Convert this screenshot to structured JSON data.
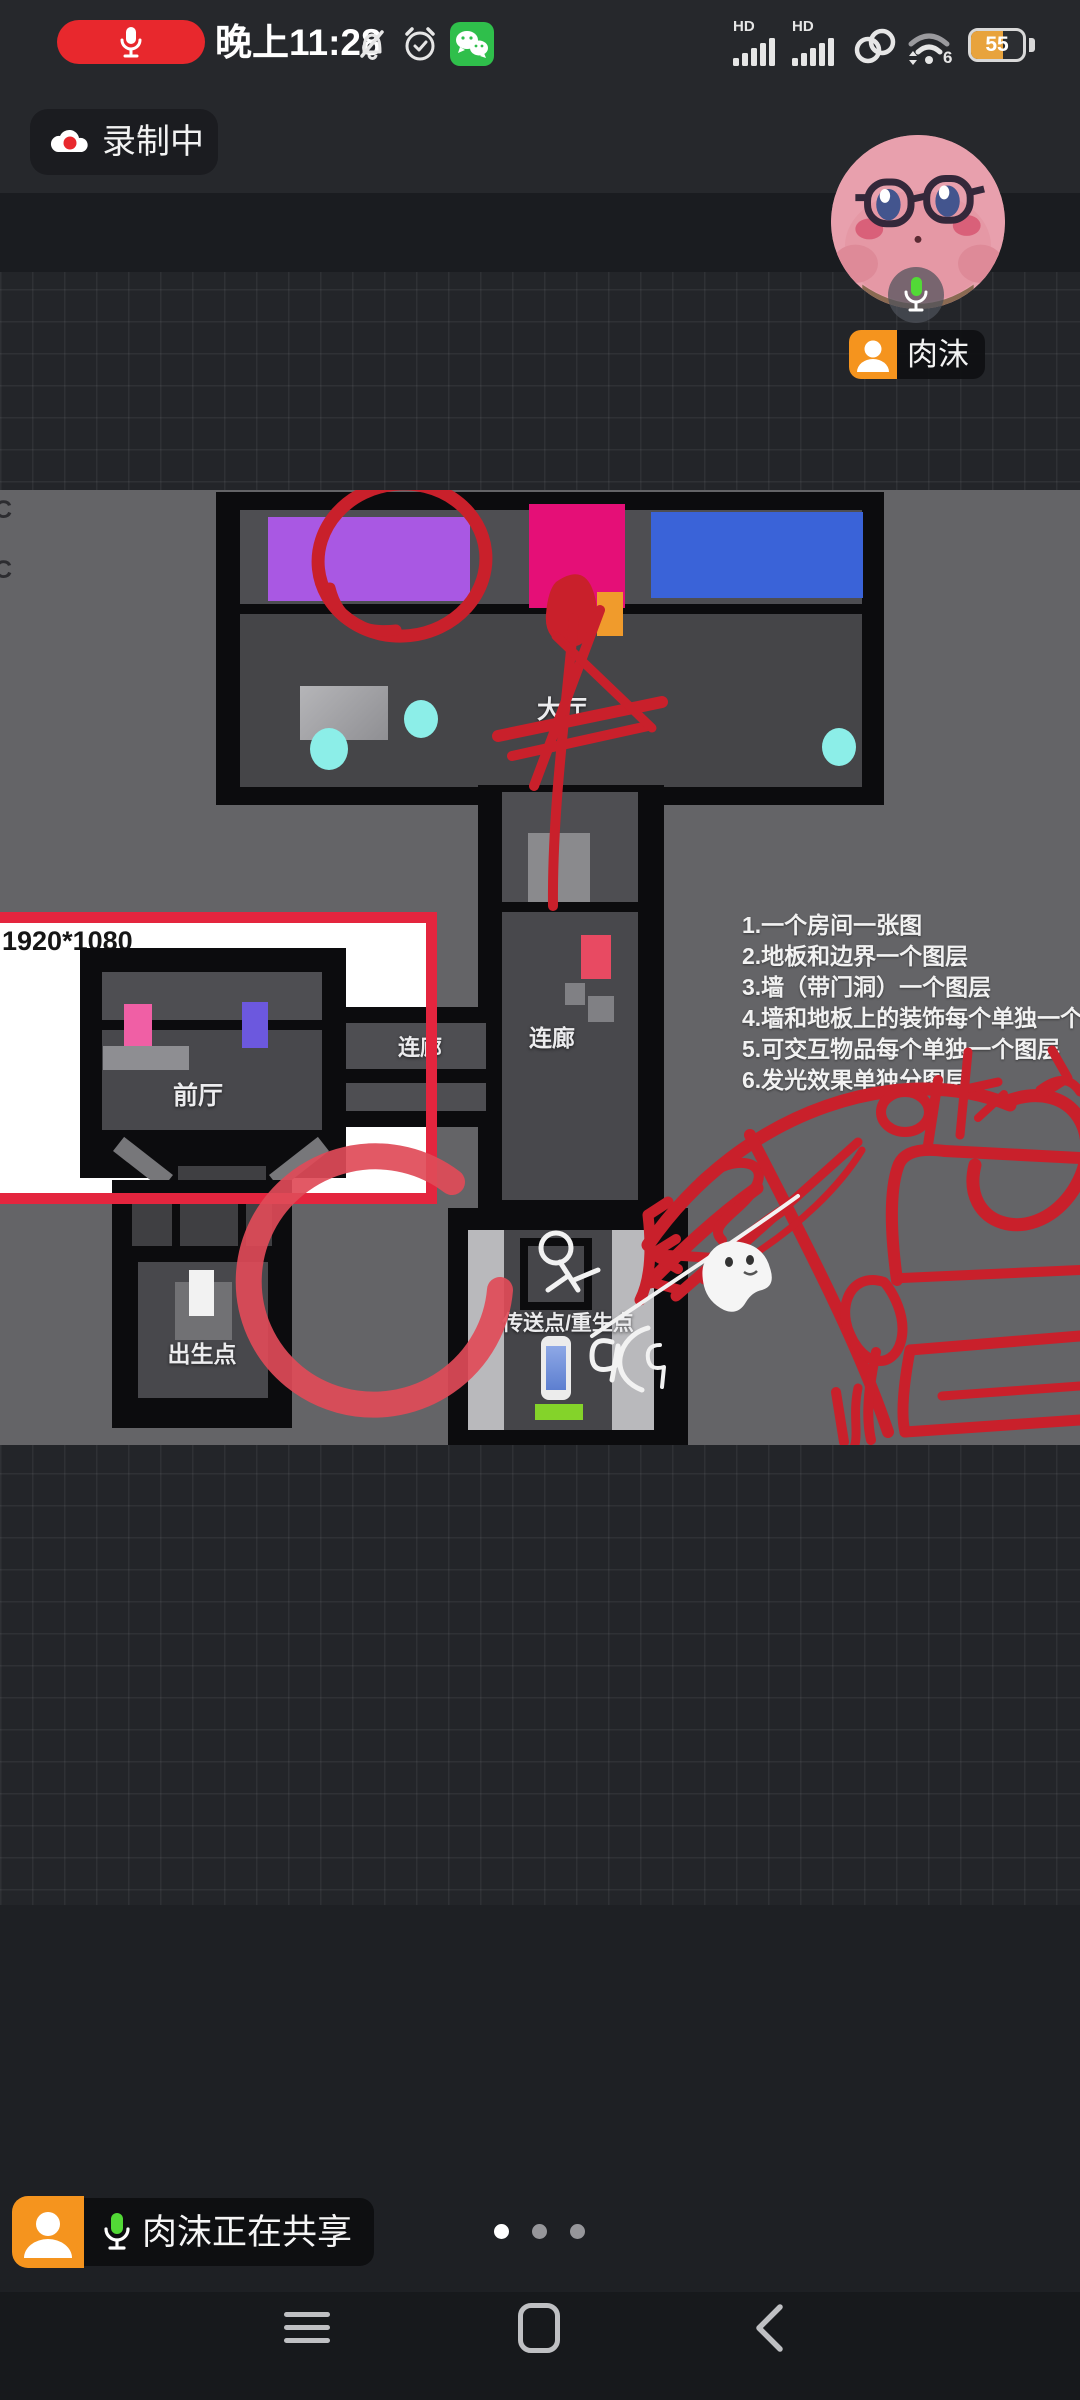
{
  "status_bar": {
    "time": "晚上11:28",
    "hd": "HD",
    "wifi_band": "6",
    "battery": "55"
  },
  "recording_badge": {
    "label": "录制中"
  },
  "participant": {
    "name": "肉沫"
  },
  "share_banner": {
    "text": "肉沫正在共享"
  },
  "map": {
    "resolution_label": "1920*1080",
    "edge_label_top": "C",
    "edge_label_bottom": "C",
    "rooms": {
      "main_hall": "大厅",
      "corridor_vertical": "连廊",
      "corridor_horizontal": "连廊",
      "front_hall": "前厅",
      "spawn_point": "出生点",
      "teleport_point": "传送点/重生点"
    },
    "notes": [
      "1.一个房间一张图",
      "2.地板和边界一个图层",
      "3.墙（带门洞）一个图层",
      "4.墙和地板上的装饰每个单独一个图层",
      "5.可交互物品每个单独一个图层",
      "6.发光效果单独分图层"
    ]
  },
  "colors": {
    "annotation_red": "#c9202b",
    "highlight_frame_red": "#e4253e",
    "record_red": "#e8282d",
    "mic_green": "#52d936",
    "tag_orange": "#f5941e",
    "battery_orange": "#e8a33d",
    "purple": "#a958e3",
    "magenta": "#e50f77",
    "blue": "#3a63d8",
    "cyan": "#8ceee8",
    "green_pad": "#84d32a"
  }
}
